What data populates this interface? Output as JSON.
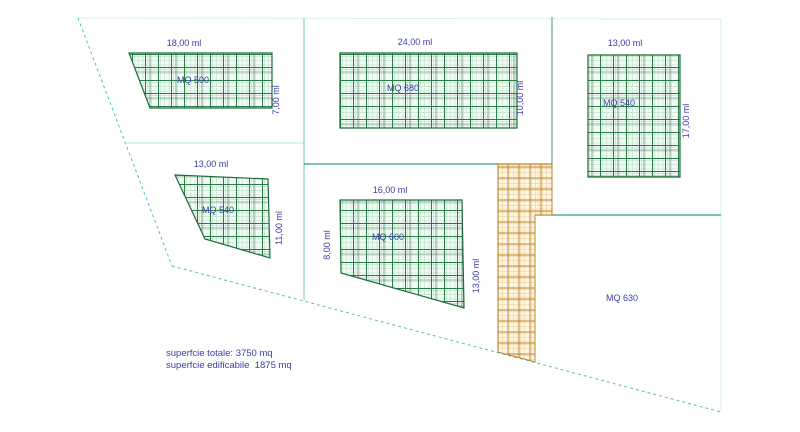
{
  "drawing": {
    "type": "site-plan",
    "plots": [
      {
        "name": "MQ 500",
        "top_dim": "18,00 ml",
        "right_dim": "7,00 ml"
      },
      {
        "name": "MQ 680",
        "top_dim": "24,00 ml",
        "right_dim": "10,00 ml"
      },
      {
        "name": "MQ 540",
        "top_dim": "13,00 ml",
        "right_dim": "17,00 ml"
      },
      {
        "name": "MQ 540",
        "top_dim": "13,00 ml",
        "right_dim": "11,00 ml"
      },
      {
        "name": "MQ 600",
        "top_dim": "16,00 ml",
        "left_dim": "8,00 ml",
        "right_dim": "13,00 ml"
      },
      {
        "name": "MQ 630"
      }
    ],
    "legend": {
      "line1": "superfcie totale: 3750 mq",
      "line2": "superfcie edificabile  1875 mq"
    },
    "colors": {
      "hatch_green_dark": "#2a7a47",
      "hatch_green_light": "#b9e2c6",
      "hatch_green_bg": "#f4fbf6",
      "hatch_orange_dark": "#b9842e",
      "hatch_orange_light": "#ecd3a0",
      "hatch_orange_bg": "#fdf6e4",
      "boundary_teal": "#3a9a92",
      "boundary_dashed": "#4fc1c1",
      "boundary_faint": "#d9f2f0",
      "label_navy": "#3c3caa"
    }
  }
}
